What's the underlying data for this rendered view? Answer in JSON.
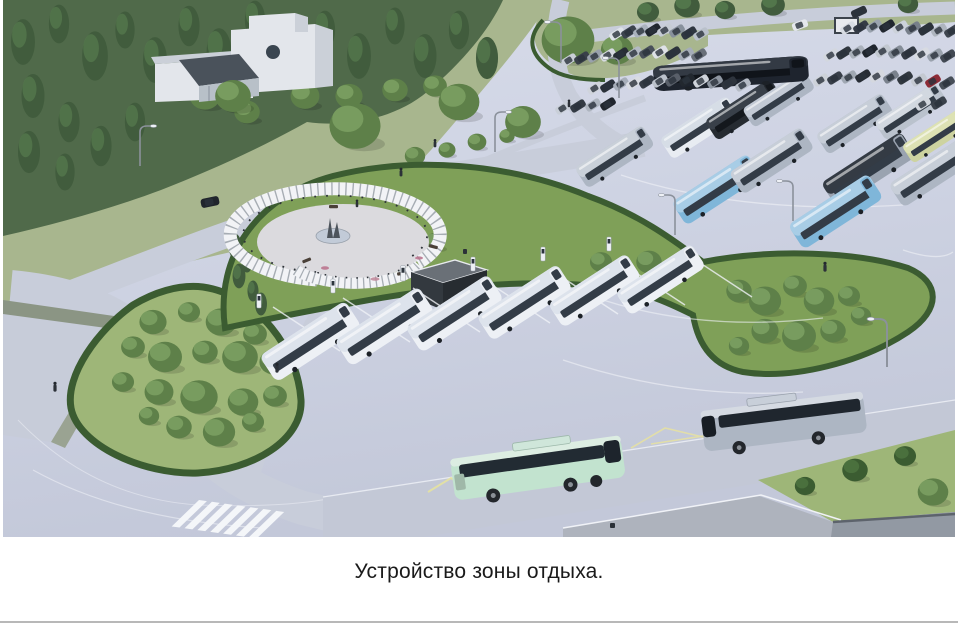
{
  "caption": {
    "text": "Устройство зоны отдыха."
  },
  "scene": {
    "alt": "Aerial 3D rendering of a rest-area: circular pergola plaza in a park, six white electric buses at charging stations, large bus and car parking lots, green islands with hedges and trees, a mint-green coach and a grey coach driving on the foreground road, a white service building among trees"
  },
  "colors": {
    "page": "#ffffff",
    "caption": "#1a1a1a",
    "divider": "#b8b8b8",
    "pavement": "#cdd2e2",
    "pavement_deep": "#c2c7d8",
    "road": "#c8cdda",
    "road_dark": "#c3c8d6",
    "lawn": "#a8b68e",
    "grass": "#7fa058",
    "grass_light": "#9eb678",
    "hedge": "#3b5c31",
    "forest": "#506a4a",
    "tree_dark": "#415c3d",
    "tree_mid": "#5e8049",
    "tree_light": "#7da163",
    "marking": "#f0f2f7",
    "lamp": "#8b919b",
    "wall": "#e3e6eb",
    "wall_shade": "#cbd0d8",
    "roof_dark": "#4a525b",
    "box_dark": "#33393f",
    "box_side": "#272c31",
    "box_top": "#6a7077",
    "bus_white": "#edf0f5",
    "bus_glass": "#333c47",
    "bus_roof": "#dde3ec",
    "bus_mint": "#c2e3cf",
    "bus_mint_roof": "#dcede2",
    "bus_silver": "#adb6c3",
    "bus_blue": "#7fb6d9",
    "bus_dark": "#262b31",
    "bus_navy": "#1e242e",
    "bus_yellow": "#cdd3a0",
    "accent_yellow": "#e6e2a0",
    "platform": "#aeb3bd",
    "platform_dark": "#9299a3",
    "fountain": "#c2cbd8"
  }
}
